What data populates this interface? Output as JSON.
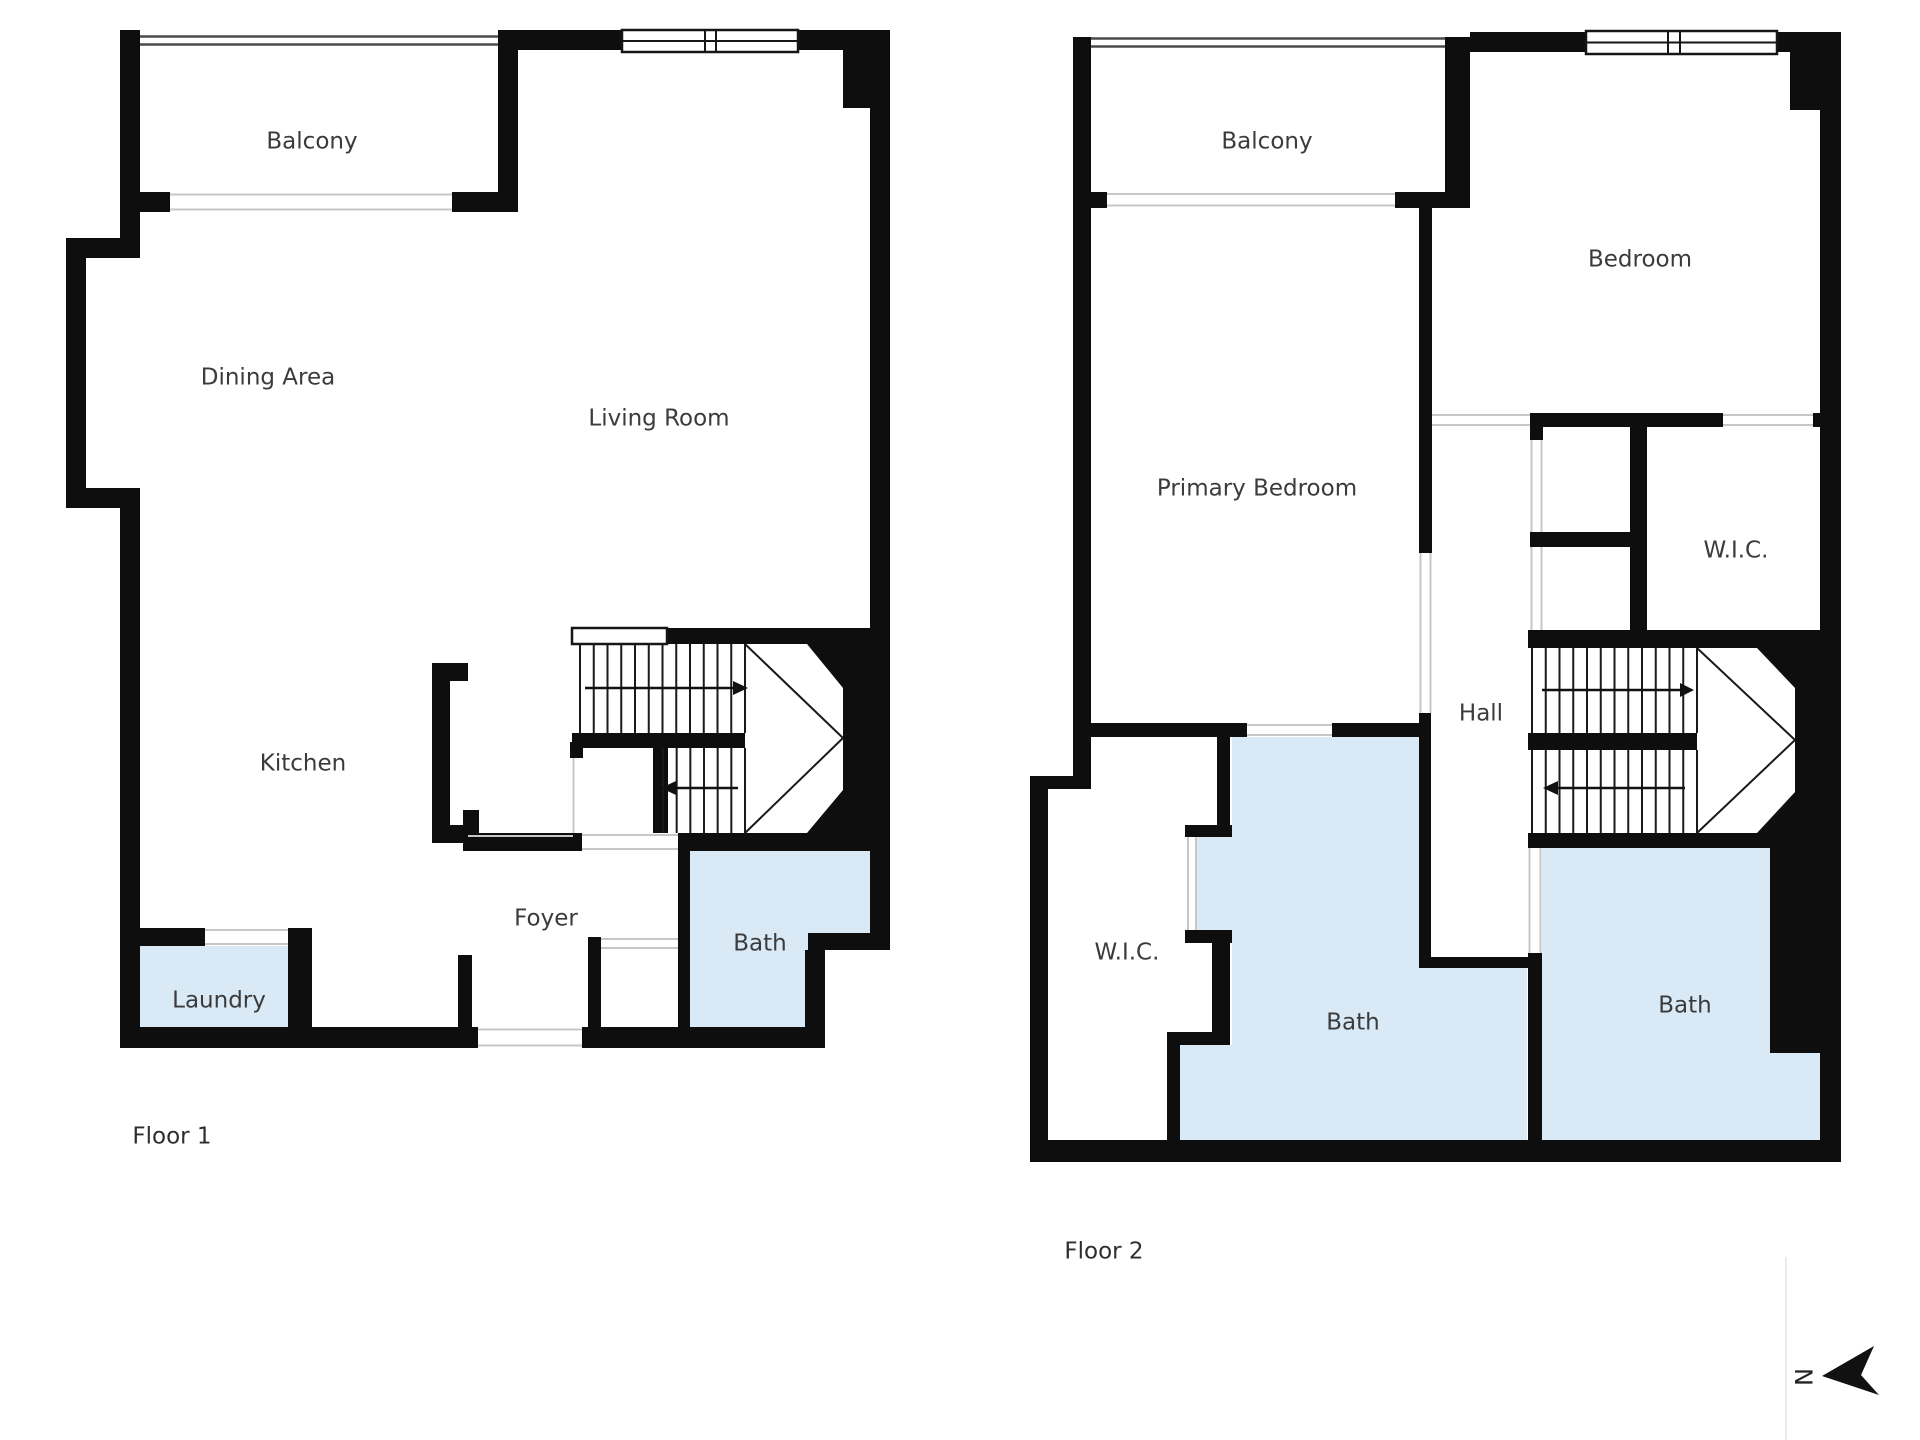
{
  "colors": {
    "wall": "#0e0e0e",
    "bath_fill": "#d9e9f6",
    "opening_line": "#c7c7c7",
    "label_text": "#3b3b3b",
    "background": "#ffffff"
  },
  "floor1": {
    "name": "Floor 1",
    "rooms": [
      {
        "label": "Balcony"
      },
      {
        "label": "Dining Area"
      },
      {
        "label": "Living Room"
      },
      {
        "label": "Kitchen"
      },
      {
        "label": "Foyer"
      },
      {
        "label": "Bath"
      },
      {
        "label": "Laundry"
      }
    ]
  },
  "floor2": {
    "name": "Floor 2",
    "rooms": [
      {
        "label": "Balcony"
      },
      {
        "label": "Bedroom"
      },
      {
        "label": "Primary Bedroom"
      },
      {
        "label": "W.I.C."
      },
      {
        "label": "Hall"
      },
      {
        "label": "W.I.C."
      },
      {
        "label": "Bath"
      },
      {
        "label": "Bath"
      }
    ]
  },
  "compass": {
    "north_label": "N"
  }
}
